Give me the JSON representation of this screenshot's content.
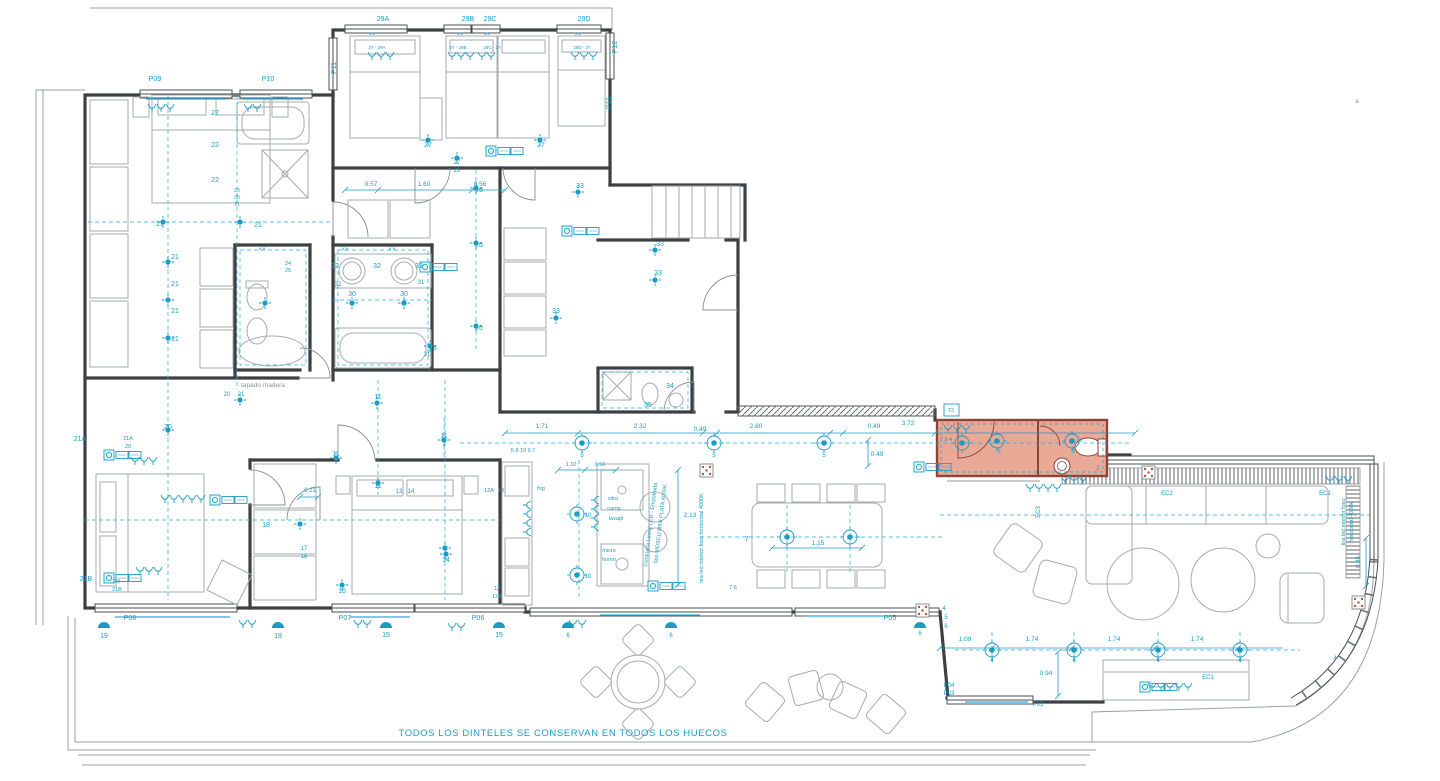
{
  "meta": {
    "note": "TODOS LOS DINTELES SE CONSERVAN EN TODOS LOS HUECOS",
    "drawing_type": "floor plan - lighting and electrical layout"
  },
  "palette": {
    "annotation": "#1a9cc5",
    "walls": "#3d4043",
    "furniture": "#a6abae",
    "gray_text": "#8e9396",
    "highlight_fill": "#eaa897",
    "highlight_stroke": "#8d4336"
  },
  "plan": {
    "texts": [
      {
        "t": "29A",
        "x": 383,
        "y": 21
      },
      {
        "t": "29B",
        "x": 468,
        "y": 21
      },
      {
        "t": "29C",
        "x": 490,
        "y": 21
      },
      {
        "t": "29D",
        "x": 584,
        "y": 21
      },
      {
        "t": "27 - 29A",
        "x": 377,
        "y": 49,
        "s": 4.5
      },
      {
        "t": "27 - 29B",
        "x": 458,
        "y": 49,
        "s": 4.5
      },
      {
        "t": "29C - 27",
        "x": 492,
        "y": 49,
        "s": 4.5
      },
      {
        "t": "29D - 27",
        "x": 582,
        "y": 49,
        "s": 4.5
      },
      {
        "t": "P09",
        "x": 155,
        "y": 81
      },
      {
        "t": "P10",
        "x": 268,
        "y": 81
      },
      {
        "t": "P11",
        "x": 336,
        "y": 68,
        "r": -90
      },
      {
        "t": "P11",
        "x": 611,
        "y": 103,
        "r": -90
      },
      {
        "t": "P12",
        "x": 617,
        "y": 47,
        "r": -90
      },
      {
        "t": "P08",
        "x": 130,
        "y": 620
      },
      {
        "t": "P07",
        "x": 345,
        "y": 620
      },
      {
        "t": "P06",
        "x": 478,
        "y": 620
      },
      {
        "t": "P05",
        "x": 890,
        "y": 620
      },
      {
        "t": "P04",
        "x": 949,
        "y": 687,
        "s": 6
      },
      {
        "t": "P03",
        "x": 949,
        "y": 695,
        "s": 6
      },
      {
        "t": "P03",
        "x": 1038,
        "y": 706,
        "s": 6
      },
      {
        "t": "21A",
        "x": 80,
        "y": 441
      },
      {
        "t": "21B",
        "x": 86,
        "y": 581
      },
      {
        "t": "EC2",
        "x": 1167,
        "y": 495,
        "s": 6
      },
      {
        "t": "EC1",
        "x": 1325,
        "y": 495,
        "s": 6
      },
      {
        "t": "EC1",
        "x": 1208,
        "y": 679,
        "s": 6
      },
      {
        "t": "EC3",
        "x": 1040,
        "y": 512,
        "r": -90,
        "s": 6
      },
      {
        "t": "T3",
        "x": 951,
        "y": 412,
        "s": 5
      },
      {
        "t": "0.57",
        "x": 371,
        "y": 186,
        "s": 6.5
      },
      {
        "t": "1.60",
        "x": 424,
        "y": 186,
        "s": 6.5
      },
      {
        "t": "0.56",
        "x": 480,
        "y": 186,
        "s": 6.5
      },
      {
        "t": "1.71",
        "x": 542,
        "y": 428,
        "s": 6.5
      },
      {
        "t": "2.32",
        "x": 640,
        "y": 428,
        "s": 6.5
      },
      {
        "t": "0.49",
        "x": 700,
        "y": 431,
        "s": 6.5
      },
      {
        "t": "2.80",
        "x": 756,
        "y": 428,
        "s": 6.5
      },
      {
        "t": "0.49",
        "x": 874,
        "y": 428,
        "s": 6.5
      },
      {
        "t": "3.72",
        "x": 908,
        "y": 425,
        "s": 6.5
      },
      {
        "t": "0.49",
        "x": 877,
        "y": 456,
        "s": 6.5
      },
      {
        "t": "1.10",
        "x": 571,
        "y": 466,
        "s": 5.5
      },
      {
        "t": "0.56",
        "x": 600,
        "y": 466,
        "s": 5.5
      },
      {
        "t": "2.13",
        "x": 690,
        "y": 517,
        "s": 6.5
      },
      {
        "t": "1.15",
        "x": 818,
        "y": 545,
        "s": 6.5
      },
      {
        "t": "1.09",
        "x": 965,
        "y": 641,
        "s": 6.5
      },
      {
        "t": "1.74",
        "x": 1032,
        "y": 641,
        "s": 6.5
      },
      {
        "t": "1.74",
        "x": 1114,
        "y": 641,
        "s": 6.5
      },
      {
        "t": "1.74",
        "x": 1197,
        "y": 641,
        "s": 6.5
      },
      {
        "t": "0.94",
        "x": 1046,
        "y": 675,
        "s": 6.5
      },
      {
        "t": "0.85",
        "x": 1360,
        "y": 562,
        "r": -90,
        "s": 6
      },
      {
        "t": "0.21",
        "x": 310,
        "y": 492,
        "s": 6
      },
      {
        "t": "22",
        "x": 215,
        "y": 115
      },
      {
        "t": "22",
        "x": 215,
        "y": 147
      },
      {
        "t": "22",
        "x": 215,
        "y": 182
      },
      {
        "t": "23",
        "x": 237,
        "y": 192,
        "s": 5
      },
      {
        "t": "20",
        "x": 237,
        "y": 199,
        "s": 5
      },
      {
        "t": "21",
        "x": 237,
        "y": 206,
        "s": 5
      },
      {
        "t": "21",
        "x": 160,
        "y": 226
      },
      {
        "t": "21",
        "x": 258,
        "y": 227
      },
      {
        "t": "21",
        "x": 175,
        "y": 259
      },
      {
        "t": "21",
        "x": 175,
        "y": 286
      },
      {
        "t": "21",
        "x": 175,
        "y": 313
      },
      {
        "t": "21",
        "x": 175,
        "y": 341
      },
      {
        "t": "20",
        "x": 227,
        "y": 396,
        "s": 6
      },
      {
        "t": "21",
        "x": 241,
        "y": 396,
        "s": 6
      },
      {
        "t": "20",
        "x": 168,
        "y": 429
      },
      {
        "t": "21A",
        "x": 128,
        "y": 440,
        "s": 5.5
      },
      {
        "t": "20",
        "x": 128,
        "y": 448,
        "s": 5.5
      },
      {
        "t": "20",
        "x": 117,
        "y": 583,
        "s": 5.5
      },
      {
        "t": "21B",
        "x": 117,
        "y": 591,
        "s": 5.5
      },
      {
        "t": "27",
        "x": 428,
        "y": 147
      },
      {
        "t": "27",
        "x": 541,
        "y": 147
      },
      {
        "t": "27",
        "x": 457,
        "y": 164,
        "s": 6
      },
      {
        "t": "26",
        "x": 457,
        "y": 172,
        "s": 6
      },
      {
        "t": "26",
        "x": 479,
        "y": 192
      },
      {
        "t": "26",
        "x": 479,
        "y": 247
      },
      {
        "t": "26",
        "x": 479,
        "y": 330
      },
      {
        "t": "26",
        "x": 433,
        "y": 350
      },
      {
        "t": "24",
        "x": 288,
        "y": 265,
        "s": 5.5
      },
      {
        "t": "25",
        "x": 288,
        "y": 272,
        "s": 5.5
      },
      {
        "t": "32",
        "x": 335,
        "y": 268
      },
      {
        "t": "32",
        "x": 377,
        "y": 268
      },
      {
        "t": "32",
        "x": 419,
        "y": 268
      },
      {
        "t": "32",
        "x": 338,
        "y": 286,
        "s": 6
      },
      {
        "t": "31",
        "x": 421,
        "y": 284,
        "s": 6
      },
      {
        "t": "30",
        "x": 352,
        "y": 296
      },
      {
        "t": "30",
        "x": 404,
        "y": 296
      },
      {
        "t": "31",
        "x": 427,
        "y": 356,
        "s": 6
      },
      {
        "t": "××",
        "x": 345,
        "y": 251,
        "s": 6
      },
      {
        "t": "××",
        "x": 392,
        "y": 251,
        "s": 6
      },
      {
        "t": "××",
        "x": 262,
        "y": 251,
        "s": 6
      },
      {
        "t": "××",
        "x": 372,
        "y": 36,
        "s": 6
      },
      {
        "t": "××",
        "x": 460,
        "y": 36,
        "s": 6
      },
      {
        "t": "××",
        "x": 487,
        "y": 36,
        "s": 6
      },
      {
        "t": "××",
        "x": 578,
        "y": 36,
        "s": 6
      },
      {
        "t": "33",
        "x": 580,
        "y": 188
      },
      {
        "t": "33",
        "x": 660,
        "y": 246
      },
      {
        "t": "33",
        "x": 658,
        "y": 275
      },
      {
        "t": "33",
        "x": 556,
        "y": 313
      },
      {
        "t": "34",
        "x": 670,
        "y": 388
      },
      {
        "t": "35",
        "x": 648,
        "y": 407
      },
      {
        "t": "11",
        "x": 378,
        "y": 399
      },
      {
        "t": "11",
        "x": 444,
        "y": 438
      },
      {
        "t": "11",
        "x": 336,
        "y": 456
      },
      {
        "t": "11",
        "x": 378,
        "y": 488
      },
      {
        "t": "13",
        "x": 399,
        "y": 493,
        "s": 6
      },
      {
        "t": "14",
        "x": 411,
        "y": 493,
        "s": 6
      },
      {
        "t": "14",
        "x": 446,
        "y": 562
      },
      {
        "t": "12A",
        "x": 489,
        "y": 492,
        "s": 5.5
      },
      {
        "t": "13",
        "x": 501,
        "y": 492,
        "s": 5.5
      },
      {
        "t": "12",
        "x": 497,
        "y": 590,
        "s": 5.5
      },
      {
        "t": "12B",
        "x": 497,
        "y": 598,
        "s": 5.5
      },
      {
        "t": "17",
        "x": 304,
        "y": 550,
        "s": 6
      },
      {
        "t": "16",
        "x": 304,
        "y": 558,
        "s": 6
      },
      {
        "t": "18",
        "x": 266,
        "y": 527
      },
      {
        "t": "15",
        "x": 342,
        "y": 593
      },
      {
        "t": "15",
        "x": 386,
        "y": 637
      },
      {
        "t": "15",
        "x": 499,
        "y": 637
      },
      {
        "t": "19",
        "x": 104,
        "y": 638
      },
      {
        "t": "19",
        "x": 278,
        "y": 638
      },
      {
        "t": "6",
        "x": 568,
        "y": 637,
        "s": 6
      },
      {
        "t": "6",
        "x": 671,
        "y": 637,
        "s": 6
      },
      {
        "t": "6",
        "x": 920,
        "y": 635,
        "s": 6
      },
      {
        "t": "5 8 10 9 7",
        "x": 523,
        "y": 452,
        "s": 5.5
      },
      {
        "t": "5",
        "x": 582,
        "y": 457,
        "s": 6
      },
      {
        "t": "5",
        "x": 714,
        "y": 457,
        "s": 6
      },
      {
        "t": "5",
        "x": 824,
        "y": 457,
        "s": 6
      },
      {
        "t": "frig",
        "x": 541,
        "y": 490,
        "s": 5.5
      },
      {
        "t": "vitro",
        "x": 613,
        "y": 500,
        "s": 5.5
      },
      {
        "t": "camp",
        "x": 614,
        "y": 510,
        "s": 5.5
      },
      {
        "t": "lavapl",
        "x": 616,
        "y": 520,
        "s": 5.5
      },
      {
        "t": "micro",
        "x": 609,
        "y": 552,
        "s": 5.5
      },
      {
        "t": "horno",
        "x": 609,
        "y": 561,
        "s": 5.5
      },
      {
        "t": "10",
        "x": 588,
        "y": 517,
        "s": 6
      },
      {
        "t": "10",
        "x": 588,
        "y": 578,
        "s": 6
      },
      {
        "t": "7",
        "x": 747,
        "y": 541
      },
      {
        "t": "7 6",
        "x": 733,
        "y": 589,
        "s": 5.5
      },
      {
        "t": "7 8 4",
        "x": 946,
        "y": 441,
        "s": 5.5
      },
      {
        "t": "3",
        "x": 999,
        "y": 453,
        "s": 6
      },
      {
        "t": "3",
        "x": 1073,
        "y": 453,
        "s": 6
      },
      {
        "t": "2",
        "x": 1098,
        "y": 470,
        "s": 6
      },
      {
        "t": "4",
        "x": 944,
        "y": 610,
        "s": 6
      },
      {
        "t": "5",
        "x": 946,
        "y": 619,
        "s": 6
      },
      {
        "t": "6",
        "x": 946,
        "y": 628,
        "s": 6
      },
      {
        "t": "4",
        "x": 992,
        "y": 662,
        "s": 6
      },
      {
        "t": "4",
        "x": 1074,
        "y": 662,
        "s": 6
      },
      {
        "t": "4",
        "x": 1158,
        "y": 662,
        "s": 6
      },
      {
        "t": "4",
        "x": 1240,
        "y": 662,
        "s": 6
      },
      {
        "t": "4",
        "x": 1335,
        "y": 660,
        "s": 6
      },
      {
        "t": "Luminaria Lineal LED - Empotrada",
        "x": 652,
        "y": 525,
        "r": -83,
        "s": 5.5
      },
      {
        "t": "tipo MOSCU MINI PLATA 4000K",
        "x": 662,
        "y": 524,
        "r": -83,
        "s": 5.5
      },
      {
        "t": "tira led interior foso horizontal 4000K",
        "x": 703,
        "y": 538,
        "r": -90,
        "s": 5.5
      },
      {
        "t": "tira led interior foso",
        "x": 1345,
        "y": 522,
        "r": -90,
        "s": 5.5
      },
      {
        "t": "horizontal 4000k",
        "x": 1353,
        "y": 522,
        "r": -90,
        "s": 5.5
      },
      {
        "t": "tapado madera",
        "x": 263,
        "y": 387,
        "c": "gray",
        "s": 6.5
      },
      {
        "t": "a",
        "x": 1357,
        "y": 103,
        "c": "gray",
        "s": 6
      }
    ],
    "lights_dot": [
      {
        "x": 163,
        "y": 222
      },
      {
        "x": 240,
        "y": 222
      },
      {
        "x": 168,
        "y": 262
      },
      {
        "x": 168,
        "y": 300
      },
      {
        "x": 168,
        "y": 338
      },
      {
        "x": 428,
        "y": 140
      },
      {
        "x": 540,
        "y": 140
      },
      {
        "x": 457,
        "y": 158
      },
      {
        "x": 352,
        "y": 303
      },
      {
        "x": 404,
        "y": 303
      },
      {
        "x": 265,
        "y": 303
      },
      {
        "x": 476,
        "y": 188
      },
      {
        "x": 476,
        "y": 243
      },
      {
        "x": 476,
        "y": 326
      },
      {
        "x": 430,
        "y": 346
      },
      {
        "x": 578,
        "y": 192
      },
      {
        "x": 655,
        "y": 250
      },
      {
        "x": 655,
        "y": 280
      },
      {
        "x": 556,
        "y": 318
      },
      {
        "x": 377,
        "y": 403
      },
      {
        "x": 444,
        "y": 440
      },
      {
        "x": 336,
        "y": 458
      },
      {
        "x": 378,
        "y": 483
      },
      {
        "x": 168,
        "y": 430
      },
      {
        "x": 240,
        "y": 400
      },
      {
        "x": 300,
        "y": 524
      },
      {
        "x": 445,
        "y": 548
      },
      {
        "x": 446,
        "y": 554
      },
      {
        "x": 342,
        "y": 585
      }
    ],
    "lights_ring": [
      {
        "x": 582,
        "y": 443
      },
      {
        "x": 714,
        "y": 443
      },
      {
        "x": 824,
        "y": 443
      },
      {
        "x": 962,
        "y": 443
      },
      {
        "x": 997,
        "y": 441
      },
      {
        "x": 1072,
        "y": 441
      },
      {
        "x": 787,
        "y": 537
      },
      {
        "x": 850,
        "y": 537
      },
      {
        "x": 577,
        "y": 514
      },
      {
        "x": 577,
        "y": 575
      },
      {
        "x": 992,
        "y": 650
      },
      {
        "x": 1074,
        "y": 650
      },
      {
        "x": 1158,
        "y": 650
      },
      {
        "x": 1240,
        "y": 650
      }
    ],
    "sconces": [
      {
        "x": 104,
        "y": 628
      },
      {
        "x": 278,
        "y": 628
      },
      {
        "x": 386,
        "y": 628
      },
      {
        "x": 499,
        "y": 628
      },
      {
        "x": 568,
        "y": 628
      },
      {
        "x": 671,
        "y": 628
      },
      {
        "x": 920,
        "y": 628
      }
    ],
    "sockets": [
      {
        "x": 104,
        "y": 450
      },
      {
        "x": 104,
        "y": 573
      },
      {
        "x": 210,
        "y": 495
      },
      {
        "x": 486,
        "y": 146
      },
      {
        "x": 562,
        "y": 226
      },
      {
        "x": 420,
        "y": 262
      },
      {
        "x": 914,
        "y": 462
      },
      {
        "x": 1140,
        "y": 682
      },
      {
        "x": 648,
        "y": 581
      }
    ],
    "switches": [
      {
        "x": 372,
        "y": 55,
        "n": 3
      },
      {
        "x": 452,
        "y": 55,
        "n": 3
      },
      {
        "x": 482,
        "y": 55,
        "n": 2
      },
      {
        "x": 575,
        "y": 55,
        "n": 3
      },
      {
        "x": 152,
        "y": 107,
        "n": 3
      },
      {
        "x": 248,
        "y": 107,
        "n": 2
      },
      {
        "x": 135,
        "y": 460,
        "n": 3
      },
      {
        "x": 165,
        "y": 498,
        "n": 5
      },
      {
        "x": 140,
        "y": 570,
        "n": 3
      },
      {
        "x": 243,
        "y": 623,
        "n": 2
      },
      {
        "x": 358,
        "y": 623,
        "n": 2
      },
      {
        "x": 452,
        "y": 626,
        "n": 2
      },
      {
        "x": 573,
        "y": 623,
        "n": 2
      },
      {
        "x": 1065,
        "y": 479,
        "n": 3
      },
      {
        "x": 1330,
        "y": 479,
        "n": 3
      },
      {
        "x": 1152,
        "y": 686,
        "n": 5
      },
      {
        "x": 1030,
        "y": 487,
        "n": 4
      },
      {
        "x": 948,
        "y": 428,
        "n": 3
      },
      {
        "x": 528,
        "y": 505,
        "n": 4,
        "r": 90
      },
      {
        "x": 596,
        "y": 500,
        "n": 4,
        "r": 90
      }
    ],
    "dims": [
      {
        "x1": 505,
        "y1": 433,
        "x2": 1135,
        "y2": 433,
        "ticks": [
          505,
          578,
          703,
          717,
          830,
          843,
          935,
          1135
        ]
      },
      {
        "x1": 345,
        "y1": 190,
        "x2": 505,
        "y2": 190,
        "ticks": [
          345,
          378,
          472,
          505
        ]
      },
      {
        "x1": 940,
        "y1": 648,
        "x2": 1283,
        "y2": 648,
        "ticks": [
          940,
          992,
          1072,
          1155,
          1238
        ]
      },
      {
        "x1": 678,
        "y1": 470,
        "x2": 678,
        "y2": 585,
        "ticks": []
      },
      {
        "x1": 772,
        "y1": 548,
        "x2": 862,
        "y2": 548,
        "ticks": [
          772,
          862
        ]
      },
      {
        "x1": 1058,
        "y1": 652,
        "x2": 1058,
        "y2": 696,
        "ticks": []
      },
      {
        "x1": 868,
        "y1": 440,
        "x2": 868,
        "y2": 466,
        "ticks": []
      },
      {
        "x1": 1366,
        "y1": 538,
        "x2": 1366,
        "y2": 586,
        "ticks": []
      },
      {
        "x1": 558,
        "y1": 470,
        "x2": 616,
        "y2": 470,
        "ticks": [
          558,
          585,
          616
        ]
      },
      {
        "x1": 300,
        "y1": 497,
        "x2": 318,
        "y2": 497,
        "ticks": [
          300,
          318
        ]
      }
    ]
  }
}
